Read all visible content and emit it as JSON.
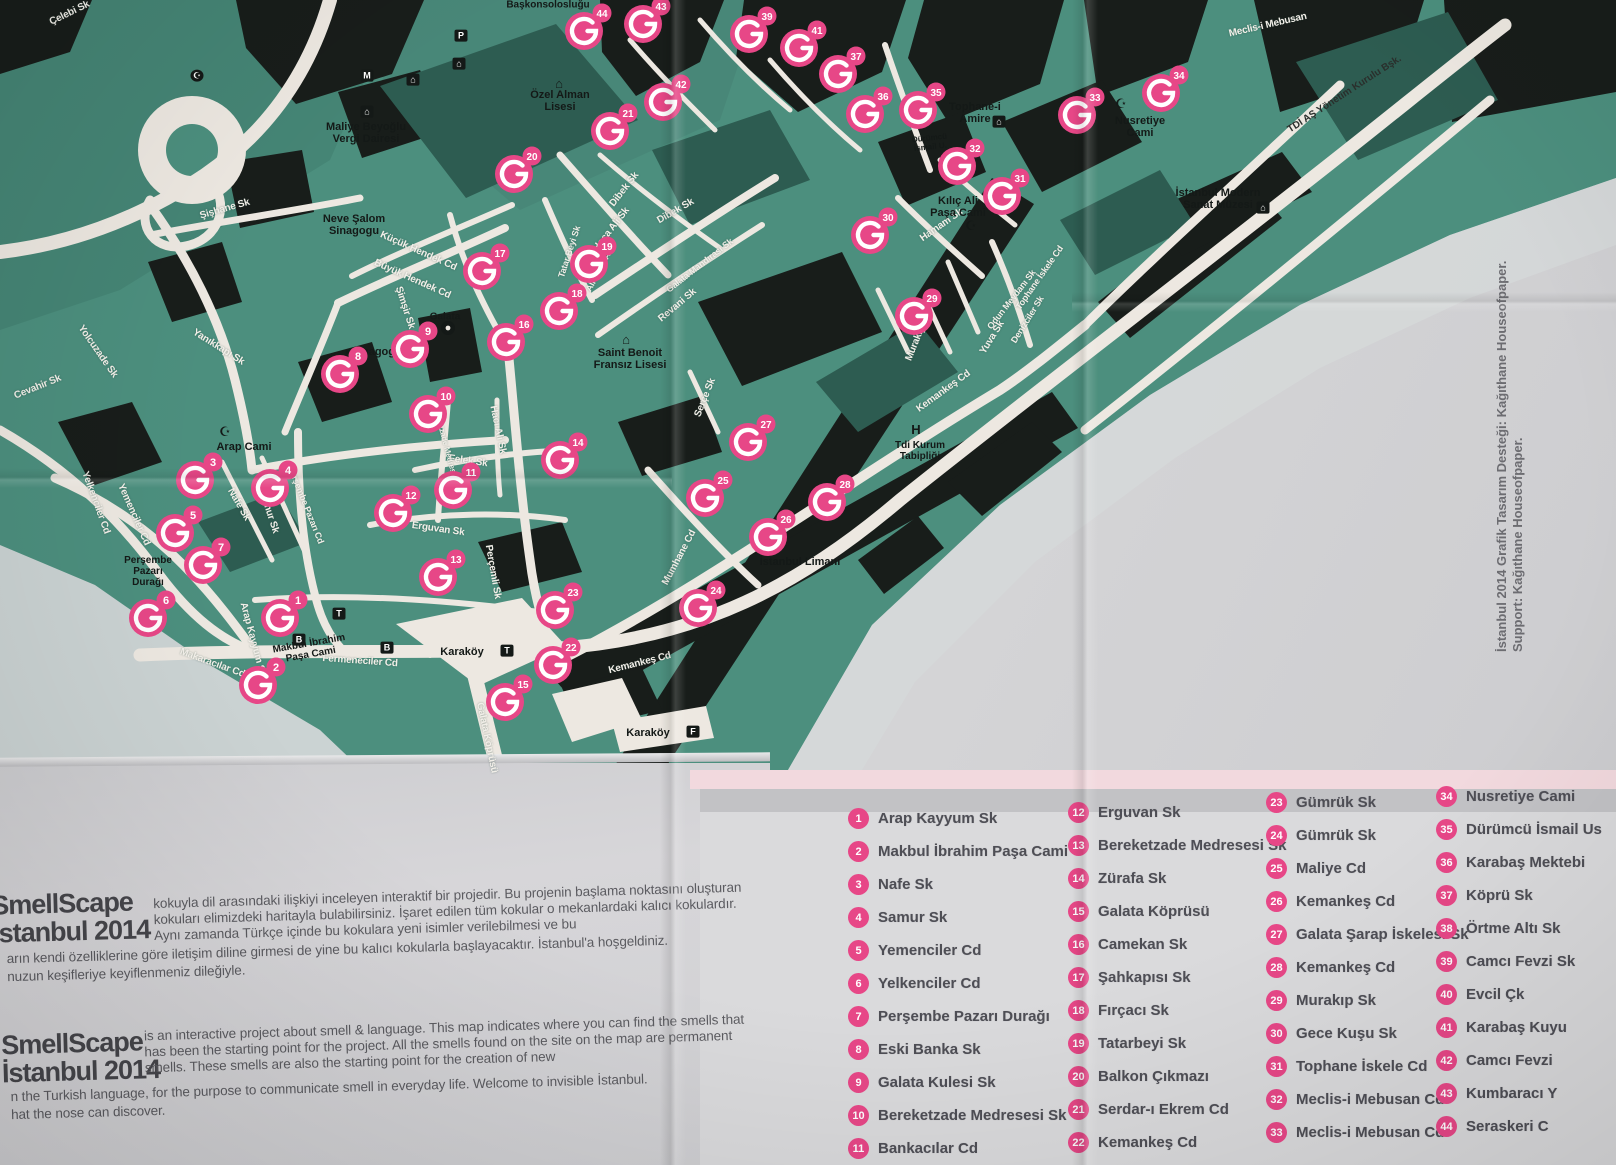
{
  "page": {
    "credit_design": "İstanbul 2014 Grafik Tasarım Desteği: Kağıthane Houseofpaper.",
    "credit_support": "Support: Kağıthane Houseofpaper."
  },
  "intro": {
    "logo_line1": "SmellScape",
    "logo_line2": "İstanbul 2014",
    "tr": {
      "part1": "kokuyla dil arasındaki ilişkiyi inceleyen interaktif bir projedir. Bu projenin başlama noktasını oluşturan kokuları elimizdeki haritayla bulabilirsiniz. İşaret edilen tüm kokular o mekanlardaki kalıcı kokulardır. Aynı zamanda Türkçe içinde bu kokulara yeni isimler verilebilmesi ve bu",
      "part2a": "arın kendi özelliklerine göre iletişim diline girmesi de yine bu kalıcı kokularla başlayacaktır. İstanbul'a hoşgeldiniz.",
      "part2b": "nuzun keşifleriye keyiflenmeniz dileğiyle."
    },
    "en": {
      "part1": "is an interactive project about smell & language. This map indicates where you can find the smells that has been the starting point for the project. All the smells found on the site on the map are permanent smells. These smells are also the starting point for the creation of new",
      "part2a": "n the Turkish language, for the purpose to communicate smell in everyday life. Welcome to invisible İstanbul.",
      "part2b": "hat the nose can discover."
    }
  },
  "legend": {
    "accent_color": "#E74787",
    "columns": [
      [
        {
          "n": "1",
          "label": "Arap Kayyum Sk"
        },
        {
          "n": "2",
          "label": "Makbul İbrahim Paşa Cami"
        },
        {
          "n": "3",
          "label": "Nafe Sk"
        },
        {
          "n": "4",
          "label": "Samur Sk"
        },
        {
          "n": "5",
          "label": "Yemenciler Cd"
        },
        {
          "n": "6",
          "label": "Yelkenciler Cd"
        },
        {
          "n": "7",
          "label": "Perşembe Pazarı Durağı"
        },
        {
          "n": "8",
          "label": "Eski Banka Sk"
        },
        {
          "n": "9",
          "label": "Galata Kulesi Sk"
        },
        {
          "n": "10",
          "label": "Bereketzade Medresesi Sk"
        },
        {
          "n": "11",
          "label": "Bankacılar Cd"
        }
      ],
      [
        {
          "n": "12",
          "label": "Erguvan Sk"
        },
        {
          "n": "13",
          "label": "Bereketzade Medresesi Sk"
        },
        {
          "n": "14",
          "label": "Zürafa Sk"
        },
        {
          "n": "15",
          "label": "Galata Köprüsü"
        },
        {
          "n": "16",
          "label": "Camekan Sk"
        },
        {
          "n": "17",
          "label": "Şahkapısı Sk"
        },
        {
          "n": "18",
          "label": "Fırçacı Sk"
        },
        {
          "n": "19",
          "label": "Tatarbeyi Sk"
        },
        {
          "n": "20",
          "label": "Balkon Çıkmazı"
        },
        {
          "n": "21",
          "label": "Serdar-ı Ekrem Cd"
        },
        {
          "n": "22",
          "label": "Kemankeş Cd"
        }
      ],
      [
        {
          "n": "23",
          "label": "Gümrük Sk"
        },
        {
          "n": "24",
          "label": "Gümrük Sk"
        },
        {
          "n": "25",
          "label": "Maliye Cd"
        },
        {
          "n": "26",
          "label": "Kemankeş Cd"
        },
        {
          "n": "27",
          "label": "Galata Şarap İskelesi Sk"
        },
        {
          "n": "28",
          "label": "Kemankeş Cd"
        },
        {
          "n": "29",
          "label": "Murakıp Sk"
        },
        {
          "n": "30",
          "label": "Gece Kuşu Sk"
        },
        {
          "n": "31",
          "label": "Tophane İskele Cd"
        },
        {
          "n": "32",
          "label": "Meclis-i Mebusan Cd"
        },
        {
          "n": "33",
          "label": "Meclis-i Mebusan Cd"
        }
      ],
      [
        {
          "n": "34",
          "label": "Nusretiye Cami"
        },
        {
          "n": "35",
          "label": "Dürümcü İsmail Us"
        },
        {
          "n": "36",
          "label": "Karabaş Mektebi"
        },
        {
          "n": "37",
          "label": "Köprü Sk"
        },
        {
          "n": "38",
          "label": "Örtme Altı Sk"
        },
        {
          "n": "39",
          "label": "Camcı Fevzi Sk"
        },
        {
          "n": "40",
          "label": "Evcil Çk"
        },
        {
          "n": "41",
          "label": "Karabaş Kuyu"
        },
        {
          "n": "42",
          "label": "Camcı Fevzi"
        },
        {
          "n": "43",
          "label": "Kumbaracı Y"
        },
        {
          "n": "44",
          "label": "Seraskeri C"
        }
      ]
    ]
  },
  "map": {
    "marker_color": "#E74787",
    "markers": [
      {
        "n": "1",
        "x": 280,
        "y": 618
      },
      {
        "n": "2",
        "x": 258,
        "y": 685
      },
      {
        "n": "3",
        "x": 195,
        "y": 480
      },
      {
        "n": "4",
        "x": 270,
        "y": 488
      },
      {
        "n": "5",
        "x": 175,
        "y": 533
      },
      {
        "n": "6",
        "x": 148,
        "y": 618
      },
      {
        "n": "7",
        "x": 203,
        "y": 565
      },
      {
        "n": "8",
        "x": 340,
        "y": 374
      },
      {
        "n": "9",
        "x": 410,
        "y": 349
      },
      {
        "n": "10",
        "x": 428,
        "y": 414
      },
      {
        "n": "11",
        "x": 453,
        "y": 490
      },
      {
        "n": "12",
        "x": 393,
        "y": 513
      },
      {
        "n": "13",
        "x": 438,
        "y": 577
      },
      {
        "n": "14",
        "x": 560,
        "y": 460
      },
      {
        "n": "15",
        "x": 505,
        "y": 702
      },
      {
        "n": "16",
        "x": 506,
        "y": 342
      },
      {
        "n": "17",
        "x": 482,
        "y": 271
      },
      {
        "n": "18",
        "x": 559,
        "y": 311
      },
      {
        "n": "19",
        "x": 589,
        "y": 264
      },
      {
        "n": "20",
        "x": 514,
        "y": 174
      },
      {
        "n": "21",
        "x": 610,
        "y": 131
      },
      {
        "n": "22",
        "x": 553,
        "y": 665
      },
      {
        "n": "23",
        "x": 555,
        "y": 610
      },
      {
        "n": "24",
        "x": 698,
        "y": 608
      },
      {
        "n": "25",
        "x": 705,
        "y": 498
      },
      {
        "n": "26",
        "x": 768,
        "y": 537
      },
      {
        "n": "27",
        "x": 748,
        "y": 442
      },
      {
        "n": "28",
        "x": 827,
        "y": 502
      },
      {
        "n": "29",
        "x": 914,
        "y": 316
      },
      {
        "n": "30",
        "x": 870,
        "y": 235
      },
      {
        "n": "31",
        "x": 1002,
        "y": 196
      },
      {
        "n": "32",
        "x": 957,
        "y": 166
      },
      {
        "n": "33",
        "x": 1077,
        "y": 115
      },
      {
        "n": "34",
        "x": 1161,
        "y": 93
      },
      {
        "n": "35",
        "x": 918,
        "y": 110
      },
      {
        "n": "36",
        "x": 865,
        "y": 114
      },
      {
        "n": "37",
        "x": 838,
        "y": 74
      },
      {
        "n": "39",
        "x": 749,
        "y": 34
      },
      {
        "n": "41",
        "x": 799,
        "y": 48
      },
      {
        "n": "42",
        "x": 663,
        "y": 102
      },
      {
        "n": "43",
        "x": 643,
        "y": 24
      },
      {
        "n": "44",
        "x": 584,
        "y": 31
      }
    ],
    "labels": [
      {
        "t": "Çelebi Sk",
        "x": 70,
        "y": 14,
        "r": -26,
        "c": "st"
      },
      {
        "t": "Şişhane Sk",
        "x": 225,
        "y": 210,
        "r": -16,
        "c": "st"
      },
      {
        "t": "Küçük Hendek Cd",
        "x": 418,
        "y": 252,
        "r": 24,
        "c": "st"
      },
      {
        "t": "Büyük Hendek Cd",
        "x": 412,
        "y": 280,
        "r": 24,
        "c": "st"
      },
      {
        "t": "Şimşir Sk",
        "x": 404,
        "y": 308,
        "r": 72,
        "c": "st"
      },
      {
        "t": "Yolcuzade Sk",
        "x": 97,
        "y": 352,
        "r": 55,
        "c": "st"
      },
      {
        "t": "Yanıkkapı Sk",
        "x": 218,
        "y": 348,
        "r": 32,
        "c": "st"
      },
      {
        "t": "Cevahir Sk",
        "x": 38,
        "y": 388,
        "r": -22,
        "c": "st"
      },
      {
        "t": "Yemenciler Cd",
        "x": 133,
        "y": 515,
        "r": 66,
        "c": "st"
      },
      {
        "t": "Yelkenciler Cd",
        "x": 95,
        "y": 503,
        "r": 70,
        "c": "st"
      },
      {
        "t": "Nafe Sk",
        "x": 238,
        "y": 505,
        "r": 60,
        "c": "st"
      },
      {
        "t": "Samur Sk",
        "x": 268,
        "y": 512,
        "r": 72,
        "c": "st"
      },
      {
        "t": "Perşembe Pazarı Cd",
        "x": 305,
        "y": 505,
        "r": 68,
        "c": "st",
        "s": 9
      },
      {
        "t": "Arap Kayyum Sk",
        "x": 252,
        "y": 640,
        "r": 75,
        "c": "st"
      },
      {
        "t": "Makaracılar Cd",
        "x": 212,
        "y": 664,
        "r": 20,
        "c": "st"
      },
      {
        "t": "Fermeneciler Cd",
        "x": 360,
        "y": 662,
        "r": 4,
        "c": "st"
      },
      {
        "t": "Galata Köprüsü",
        "x": 486,
        "y": 738,
        "r": 78,
        "c": "st"
      },
      {
        "t": "Erguvan Sk",
        "x": 438,
        "y": 530,
        "r": 8,
        "c": "st"
      },
      {
        "t": "Perçemli Sk",
        "x": 492,
        "y": 572,
        "r": 80,
        "c": "st"
      },
      {
        "t": "Felek Sk",
        "x": 468,
        "y": 462,
        "r": 8,
        "c": "st"
      },
      {
        "t": "Hacı Ali Sk",
        "x": 497,
        "y": 430,
        "r": 78,
        "c": "st"
      },
      {
        "t": "Bereketzade Medresesi Sk",
        "x": 446,
        "y": 448,
        "r": 75,
        "c": "st",
        "s": 8
      },
      {
        "t": "Kemankeş Cd",
        "x": 640,
        "y": 664,
        "r": -14,
        "c": "st"
      },
      {
        "t": "Mumhane Cd",
        "x": 680,
        "y": 558,
        "r": -62,
        "c": "st"
      },
      {
        "t": "Serçe Sk",
        "x": 706,
        "y": 398,
        "r": -68,
        "c": "st"
      },
      {
        "t": "Kemankeş Cd",
        "x": 944,
        "y": 392,
        "r": -36,
        "c": "st"
      },
      {
        "t": "Galata Mandırası Sk",
        "x": 700,
        "y": 266,
        "r": -38,
        "c": "st",
        "s": 9
      },
      {
        "t": "Revani Sk",
        "x": 678,
        "y": 306,
        "r": -40,
        "c": "st"
      },
      {
        "t": "Hoca Ali Sk",
        "x": 612,
        "y": 230,
        "r": -52,
        "c": "st"
      },
      {
        "t": "Dibek Sk",
        "x": 625,
        "y": 190,
        "r": -52,
        "c": "st"
      },
      {
        "t": "Dibek Sk",
        "x": 676,
        "y": 212,
        "r": -30,
        "c": "st"
      },
      {
        "t": "Tatar Beyi Sk",
        "x": 570,
        "y": 252,
        "r": -72,
        "c": "st",
        "s": 9
      },
      {
        "t": "Ali Hoca Ar.",
        "x": 600,
        "y": 270,
        "r": -62,
        "c": "st",
        "s": 9
      },
      {
        "t": "Hamam Sk",
        "x": 942,
        "y": 226,
        "r": -35,
        "c": "st"
      },
      {
        "t": "Tophane İskele Cd",
        "x": 1040,
        "y": 278,
        "r": -55,
        "c": "st",
        "s": 9
      },
      {
        "t": "Odun Meydanı Sk",
        "x": 1012,
        "y": 300,
        "r": -52,
        "c": "st",
        "s": 9
      },
      {
        "t": "Denizciler Sk",
        "x": 1028,
        "y": 320,
        "r": -58,
        "c": "st",
        "s": 9
      },
      {
        "t": "Yuva Sk",
        "x": 993,
        "y": 338,
        "r": -58,
        "c": "st"
      },
      {
        "t": "Murakıp Sk",
        "x": 919,
        "y": 337,
        "r": -68,
        "c": "st"
      },
      {
        "t": "Meclis-i Mebusan",
        "x": 1268,
        "y": 26,
        "r": -13,
        "c": "st"
      },
      {
        "t": "TDİ AŞ Yönetim Kurulu Bşk.",
        "x": 1345,
        "y": 95,
        "r": -33,
        "c": "pl2"
      },
      {
        "t": "Başkonsolosluğu",
        "x": 548,
        "y": 6,
        "r": 0,
        "c": "pl",
        "s": 10
      },
      {
        "t": "Özel Alman\nLisesi",
        "x": 560,
        "y": 102,
        "r": 0,
        "c": "pl"
      },
      {
        "t": "",
        "icon": "school",
        "x": 560,
        "y": 84,
        "c": "pl"
      },
      {
        "t": "Maliye Beyoğlu\nVergi Dairesi",
        "x": 366,
        "y": 134,
        "r": 0,
        "c": "pl"
      },
      {
        "t": "",
        "icon": "museum",
        "x": 368,
        "y": 112,
        "c": "pl"
      },
      {
        "t": "Neve Şalom\nSinagogu",
        "x": 354,
        "y": 226,
        "r": 0,
        "c": "pl"
      },
      {
        "t": "Sinagog",
        "x": 370,
        "y": 352,
        "r": 0,
        "c": "pl",
        "icon": "dot"
      },
      {
        "t": "Galata",
        "x": 445,
        "y": 318,
        "r": 0,
        "c": "pl",
        "s": 10
      },
      {
        "t": "Arap Cami",
        "x": 244,
        "y": 448,
        "r": 0,
        "c": "pl"
      },
      {
        "t": "",
        "icon": "mosque",
        "x": 226,
        "y": 432,
        "c": "pl"
      },
      {
        "t": "Saint Benoit\nFransız Lisesi",
        "x": 630,
        "y": 360,
        "r": 0,
        "c": "pl"
      },
      {
        "t": "",
        "icon": "school",
        "x": 627,
        "y": 340,
        "c": "pl"
      },
      {
        "t": "Tophane-i\nAmire",
        "x": 975,
        "y": 114,
        "r": 0,
        "c": "pl"
      },
      {
        "t": "",
        "icon": "museum",
        "x": 1000,
        "y": 122,
        "c": "pl"
      },
      {
        "t": "Dürümcü\nİsmail U.",
        "x": 930,
        "y": 143,
        "r": -6,
        "c": "pl",
        "s": 8
      },
      {
        "t": "Nusretiye\nCami",
        "x": 1140,
        "y": 128,
        "r": 0,
        "c": "pl"
      },
      {
        "t": "",
        "icon": "mosque",
        "x": 1122,
        "y": 104,
        "c": "pl"
      },
      {
        "t": "İstanbul Modern\nSanat Müzesi",
        "x": 1218,
        "y": 200,
        "r": 0,
        "c": "pl"
      },
      {
        "t": "",
        "icon": "museum",
        "x": 1264,
        "y": 208,
        "c": "pl"
      },
      {
        "t": "Kılıç Ali\nPaşa Cami",
        "x": 958,
        "y": 208,
        "r": 0,
        "c": "pl"
      },
      {
        "t": "",
        "icon": "mosque",
        "x": 972,
        "y": 226,
        "c": "pl"
      },
      {
        "t": "H",
        "x": 916,
        "y": 430,
        "r": 0,
        "c": "pl",
        "s": 13
      },
      {
        "t": "Tdi Kurum\nTabipliği",
        "x": 920,
        "y": 452,
        "r": 0,
        "c": "pl",
        "s": 10
      },
      {
        "t": "İstanbul Limanı",
        "x": 800,
        "y": 563,
        "r": 0,
        "c": "pl"
      },
      {
        "t": "Karaköy",
        "x": 462,
        "y": 653,
        "r": 0,
        "c": "pl"
      },
      {
        "t": "",
        "icon": "tram",
        "x": 508,
        "y": 651,
        "c": "pl"
      },
      {
        "t": "Karaköy",
        "x": 648,
        "y": 734,
        "r": 0,
        "c": "pl"
      },
      {
        "t": "",
        "icon": "ferry",
        "x": 694,
        "y": 732,
        "c": "pl"
      },
      {
        "t": "Perşembe\nPazarı\nDurağı",
        "x": 148,
        "y": 572,
        "r": 0,
        "c": "pl",
        "s": 10
      },
      {
        "t": "Makbul İbrahim\nPaşa Cami",
        "x": 310,
        "y": 650,
        "r": -10,
        "c": "pl",
        "s": 10
      },
      {
        "t": "",
        "icon": "metro",
        "x": 368,
        "y": 76,
        "c": "pl"
      },
      {
        "t": "",
        "icon": "museum",
        "x": 414,
        "y": 80,
        "c": "pl"
      },
      {
        "t": "",
        "icon": "museum",
        "x": 460,
        "y": 64,
        "c": "pl"
      },
      {
        "t": "",
        "icon": "parking",
        "x": 462,
        "y": 36,
        "c": "pl"
      },
      {
        "t": "",
        "icon": "moon",
        "x": 198,
        "y": 76,
        "c": "pl"
      },
      {
        "t": "",
        "icon": "bus",
        "x": 388,
        "y": 648,
        "c": "pl"
      },
      {
        "t": "",
        "icon": "bus",
        "x": 300,
        "y": 640,
        "c": "pl"
      },
      {
        "t": "",
        "icon": "tram",
        "x": 340,
        "y": 614,
        "c": "pl"
      }
    ]
  }
}
